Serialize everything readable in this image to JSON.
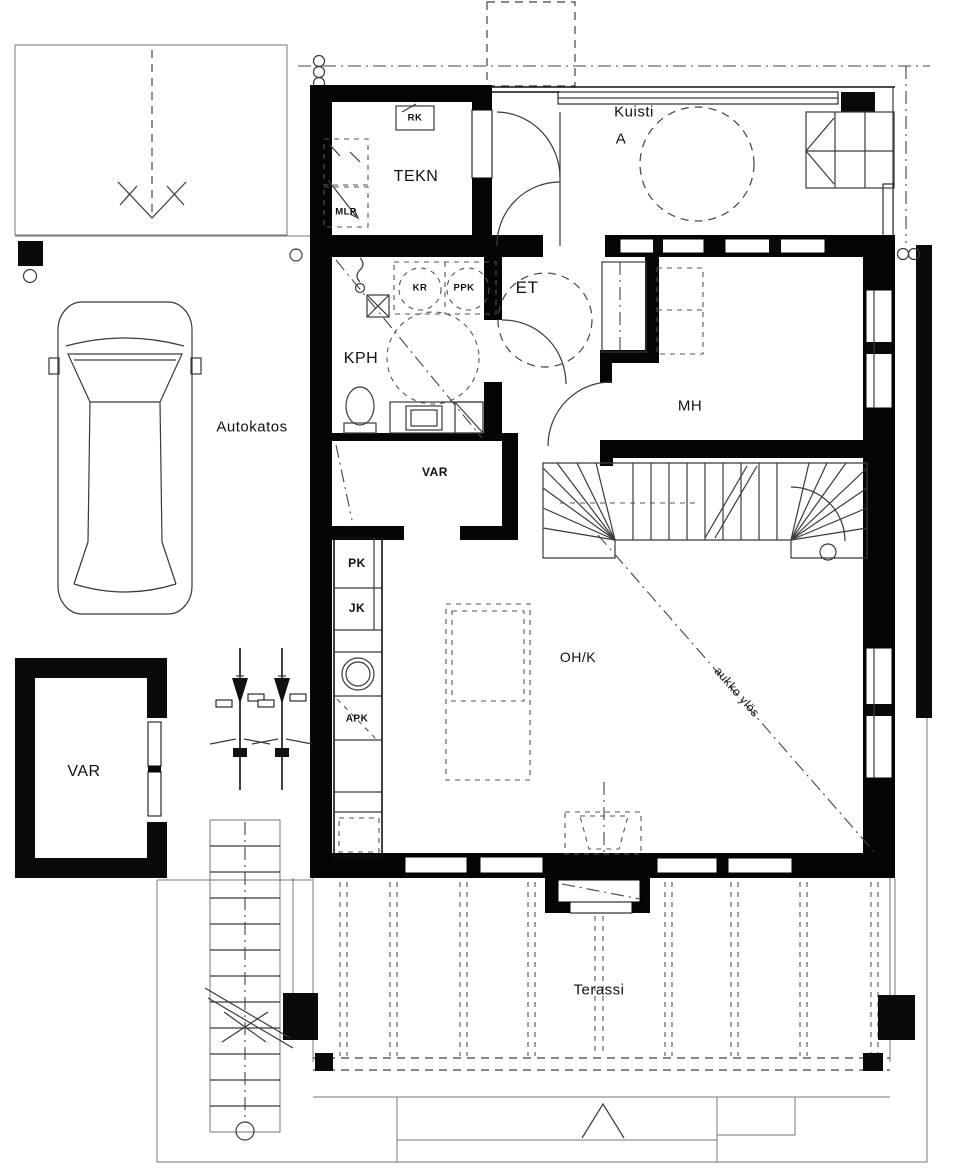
{
  "title": "floor-plan",
  "labels": {
    "kuisti": "Kuisti",
    "kuisti_sub": "A",
    "tekn": "TEKN",
    "rk": "RK",
    "mlp": "MLP",
    "kph": "KPH",
    "kr": "KR",
    "ppk": "PPK",
    "et": "ET",
    "mh": "MH",
    "autokatos": "Autokatos",
    "var_closet": "VAR",
    "pk": "PK",
    "jk": "JK",
    "apk": "APK",
    "ohk": "OH/K",
    "aukko_ylos": "aukko ylös",
    "var_storage": "VAR",
    "terassi": "Terassi"
  },
  "colors": {
    "wall": "#050505",
    "line": "#3a3a3a",
    "background": "#ffffff"
  }
}
